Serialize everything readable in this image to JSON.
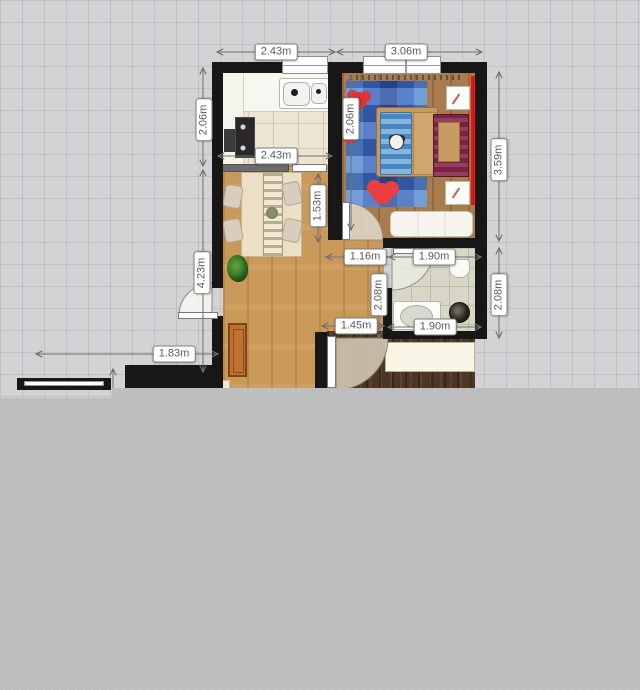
{
  "canvas": {
    "background_color": "#d3d3d6",
    "grid_color": "#c5c5ca",
    "unrendered_overlay_color": "#bdbdbd"
  },
  "palette": {
    "wall": "#171717",
    "accent_wall_red": "#e01414",
    "rug_blue": "#3e6cc0",
    "mickey_red": "#e23434",
    "living_floor_wood": "#c9995a",
    "bedroom_floor_wood": "#a87c4c",
    "entry_floor_wood": "#4e3627",
    "kitchen_tile": "#ebe5d2",
    "bathroom_tile": "#d7d6c7",
    "dimension_text": "#5a5a5a"
  },
  "dimension_labels": [
    {
      "id": "kitchen-width-top",
      "text": "2.43m",
      "x": 276,
      "y": 52,
      "vertical": false
    },
    {
      "id": "bedroom-width-top",
      "text": "3.06m",
      "x": 406,
      "y": 52,
      "vertical": false
    },
    {
      "id": "kitchen-depth-left",
      "text": "2.06m",
      "x": 204,
      "y": 120,
      "vertical": true
    },
    {
      "id": "living-depth-left",
      "text": "4.23m",
      "x": 202,
      "y": 273,
      "vertical": true
    },
    {
      "id": "bedroom-depth-right",
      "text": "3.59m",
      "x": 499,
      "y": 160,
      "vertical": true
    },
    {
      "id": "bathroom-depth-right",
      "text": "2.08m",
      "x": 499,
      "y": 295,
      "vertical": true
    },
    {
      "id": "kitchen-width-inner",
      "text": "2.43m",
      "x": 276,
      "y": 156,
      "vertical": false
    },
    {
      "id": "bedroom-depth-inner",
      "text": "2.06m",
      "x": 351,
      "y": 119,
      "vertical": true
    },
    {
      "id": "living-clearance-inner",
      "text": "1.53m",
      "x": 318,
      "y": 206,
      "vertical": true
    },
    {
      "id": "hall-width-inner",
      "text": "1.16m",
      "x": 365,
      "y": 257,
      "vertical": false
    },
    {
      "id": "hall-depth-inner",
      "text": "2.08m",
      "x": 379,
      "y": 295,
      "vertical": true
    },
    {
      "id": "hall-width-lower",
      "text": "1.45m",
      "x": 356,
      "y": 326,
      "vertical": false
    },
    {
      "id": "bathroom-width-top",
      "text": "1.90m",
      "x": 434,
      "y": 257,
      "vertical": false
    },
    {
      "id": "bathroom-width-bottom",
      "text": "1.90m",
      "x": 435,
      "y": 327,
      "vertical": false
    },
    {
      "id": "balcony-width",
      "text": "1.83m",
      "x": 174,
      "y": 354,
      "vertical": false
    }
  ]
}
